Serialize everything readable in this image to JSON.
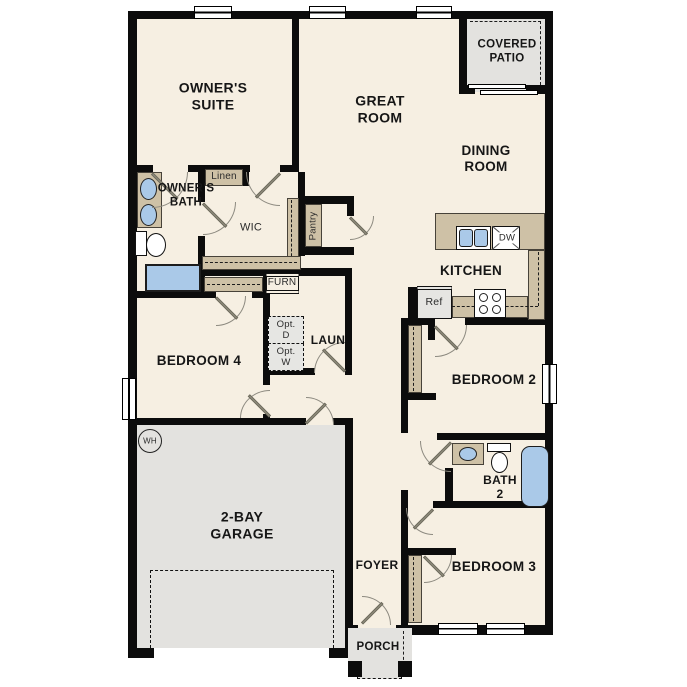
{
  "plan": {
    "rooms": {
      "owners_suite": "OWNER'S\nSUITE",
      "great_room": "GREAT\nROOM",
      "covered_patio": "COVERED\nPATIO",
      "dining_room": "DINING\nROOM",
      "kitchen": "KITCHEN",
      "bedroom2": "BEDROOM 2",
      "bath2": "BATH\n2",
      "bedroom3": "BEDROOM 3",
      "bedroom4": "BEDROOM 4",
      "garage": "2-BAY\nGARAGE",
      "foyer": "FOYER",
      "porch": "PORCH",
      "laundry": "LAUN",
      "owners_bath": "OWNER'S\nBATH",
      "wic": "WIC"
    },
    "closets": {
      "linen": "Linen",
      "pantry": "Pantry"
    },
    "fixtures": {
      "furnace": "FURN",
      "opt_dryer": "Opt.\nD",
      "opt_washer": "Opt.\nW",
      "fridge": "Ref",
      "dishwasher": "DW",
      "water_heater": "WH"
    },
    "colors": {
      "floor": "#f6efe2",
      "wall": "#0c0c0c",
      "counter": "#cec1a6",
      "concrete": "#e3e2df",
      "fixture_blue": "#aac9e8"
    }
  }
}
